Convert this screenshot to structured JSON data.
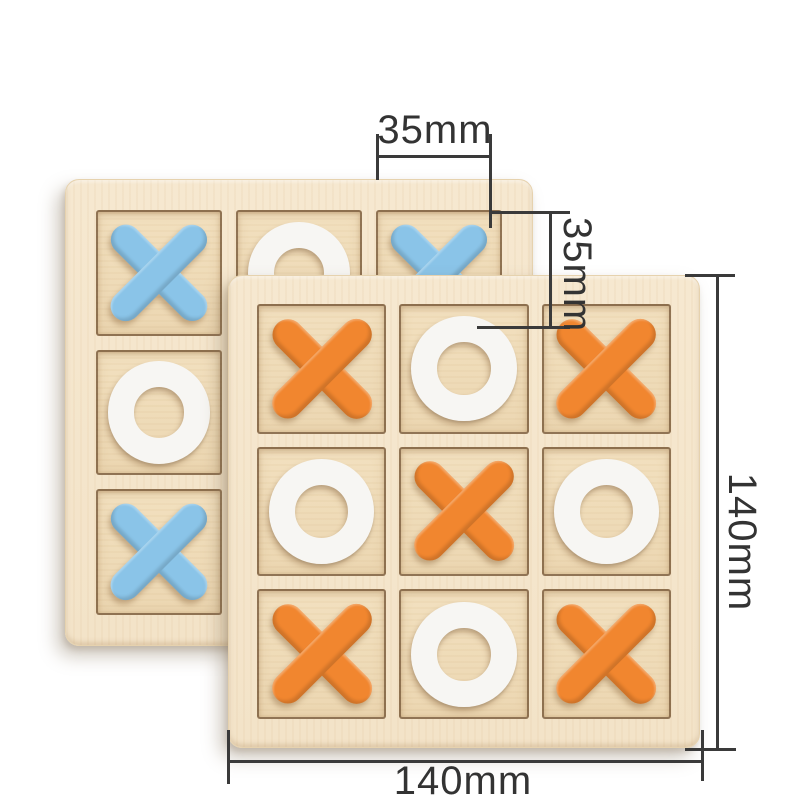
{
  "scene": {
    "background_color": "#ffffff",
    "subject": "wooden tic-tac-toe XO board game, two boards with dimension annotations"
  },
  "colors": {
    "board_wood": "#f6e8d0",
    "cell_wood": "#eed9b6",
    "x_blue": "#8ac4e8",
    "x_orange": "#f1862f",
    "o_white": "#f7f6f3",
    "dimension_line": "#3a3a3a",
    "dimension_text": "#333333"
  },
  "dimensions": {
    "cell_width_label": "35mm",
    "cell_height_label": "35mm",
    "board_height_label": "140mm",
    "board_width_label": "140mm"
  },
  "boards": {
    "back": {
      "x_color": "blue",
      "cells": [
        "x-blue",
        "o-white",
        "x-blue",
        "o-white",
        "empty",
        "empty",
        "x-blue",
        "empty",
        "empty"
      ]
    },
    "front": {
      "x_color": "orange",
      "cells": [
        "x-orange",
        "o-white",
        "x-orange",
        "o-white",
        "x-orange",
        "o-white",
        "x-orange",
        "o-white",
        "x-orange"
      ]
    }
  }
}
